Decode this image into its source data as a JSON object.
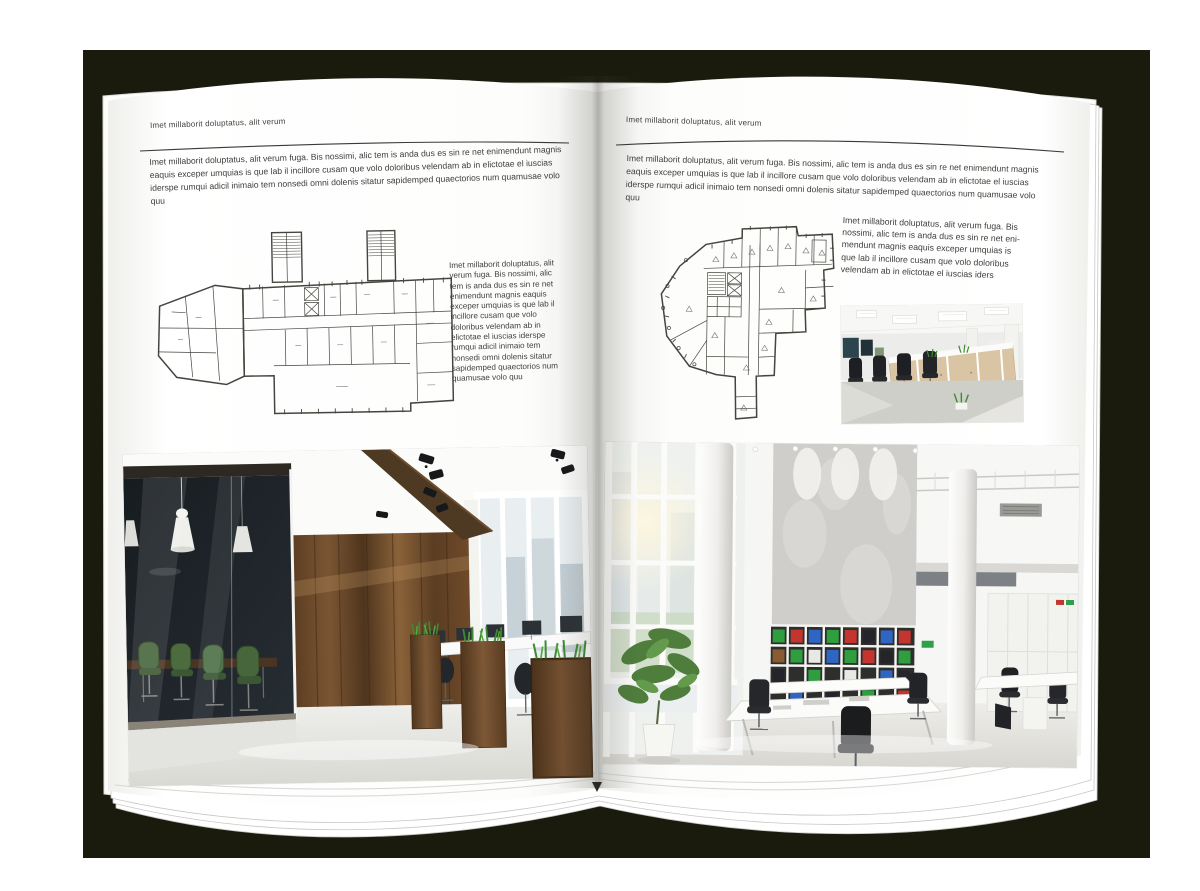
{
  "canvas": {
    "width": 1200,
    "height": 891,
    "outer_background": "#ffffff",
    "backdrop_color": "#1a1b0c",
    "page_color": "#ffffff",
    "text_color": "#3e3e3e"
  },
  "left_page": {
    "header": "Imet millaborit doluptatus, alit verum",
    "intro": "Imet millaborit doluptatus, alit verum fuga. Bis nossimi, alic tem is anda dus es sin re net enimendunt magnis eaquis exceper umquias is que lab il incillore cusam que volo doloribus velendam ab in elictotae el iuscias iderspe rumqui adicil inimaio tem nonsedi omni dolenis sitatur sapidemped quaectorios num quamusae volo quu",
    "side_text": "Imet millaborit doluptatus, alit verum fuga. Bis nossimi, alic tem is anda dus es sin re net enimendunt magnis eaquis exceper umquias is que lab il incillore cusam que volo doloribus velendam ab in elictotae el iuscias iderspe rumqui adicil inimaio tem nonsedi omni dolenis sitatur sapidemped quaectorios num quamusae volo quu",
    "floor_plan": "floor-plan-wide-building-two-stair-towers",
    "photo": "office-photo-wood-wall-glass-meeting-room"
  },
  "right_page": {
    "header": "Imet millaborit doluptatus, alit verum",
    "intro": "Imet millaborit doluptatus, alit verum fuga. Bis nossimi, alic tem is anda dus es sin re net enimendunt magnis eaquis exceper umquias is que lab il incillore cusam que volo doloribus velendam ab in elictotae el iuscias iderspe rumqui adicil inimaio tem nonsedi omni dolenis sitatur sapidemped quaectorios num quamusae volo quu",
    "side_text": "Imet millaborit doluptatus, alit verum fuga. Bis nossimi, alic tem is anda dus es sin re net eni-mendunt magnis eaquis exceper umquias is que lab il incillore cusam que volo doloribus velendam ab in elictotae el iuscias iders",
    "floor_plan": "floor-plan-irregular-wedge-building",
    "photo_small": "office-photo-open-space-workstations",
    "photo_large": "office-photo-white-atrium-bookshelves"
  },
  "accents": {
    "rule_color": "#3a3a3a",
    "wood_brown": "#6f4a2a",
    "plant_green": "#3f8a33",
    "binder_red": "#c5352f",
    "binder_green": "#2f9e3f",
    "binder_blue": "#2f66c4"
  }
}
